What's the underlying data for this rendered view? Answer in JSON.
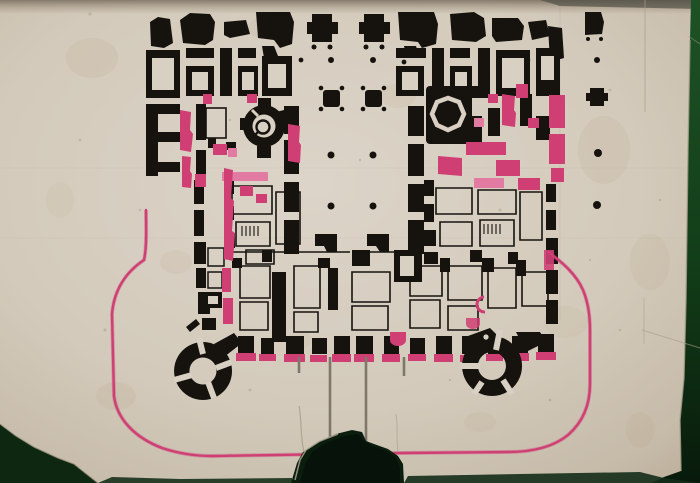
{
  "artwork": {
    "kind": "scanned hand-drawn architectural floor plan, black ink poché with pink alteration walls on aged paper, photographed on a dark green backing",
    "visible_text": "",
    "colors": {
      "backdrop": "#1a4c22",
      "backdrop_dark": "#09190b",
      "paper": "#d8d0c3",
      "paper_mid": "#cdc3b3",
      "paper_edge": "#b9ab96",
      "ink": "#16130f",
      "pink": "#cf3f74",
      "pink_deep": "#a83a68",
      "pink_light": "#e27ba2",
      "path_gray": "#7e776b",
      "stain": "#b0966f",
      "crack": "#a89c8a",
      "tear": "#0b1d0d"
    },
    "elements": {
      "north_facade": "row of detached pavilion piers along the top",
      "courtyard": "central hall with two rows of column dots and pier clusters",
      "stair_tower_round": "round stair tower with circular glyph, left wing",
      "tower_octagonal": "octagonal tower, right wing",
      "pink_walls": "pink highlighted alteration walls in both wings",
      "south_facade": "lower wing with buttress piers on pink pads",
      "corner_towers": "two round corner towers flanking the forecourt",
      "forecourt_boundary": "large pink rounded forecourt outline",
      "paths": "two grey path lines on the central axis",
      "damage": "torn bottom-centre hole, chipped bottom-left corner, green backing visible at edges"
    }
  }
}
